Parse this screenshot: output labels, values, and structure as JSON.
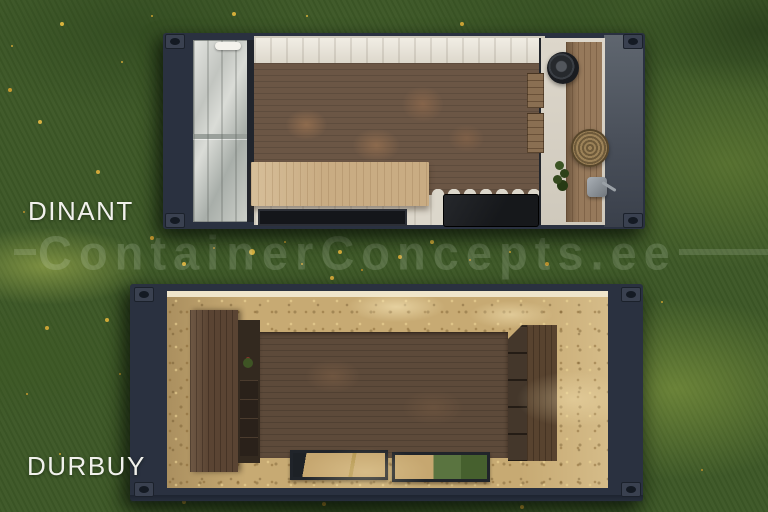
{
  "watermark": {
    "text": "ContainerConcepts.ee"
  },
  "models": [
    {
      "name": "DINANT"
    },
    {
      "name": "DURBUY"
    }
  ],
  "colors": {
    "container_frame": "#2a3140",
    "grass_base": "#3d5827",
    "label_text": "#f1f1ec",
    "osb_panel": "#c7aa73",
    "floor_dinant": "#6b5645",
    "floor_durbuy": "#5d4a3a",
    "island_wood": "#c9ac83",
    "corrugated_wall": "#e9e5dc",
    "watermark_tint": "rgba(228,238,222,0.17)"
  }
}
